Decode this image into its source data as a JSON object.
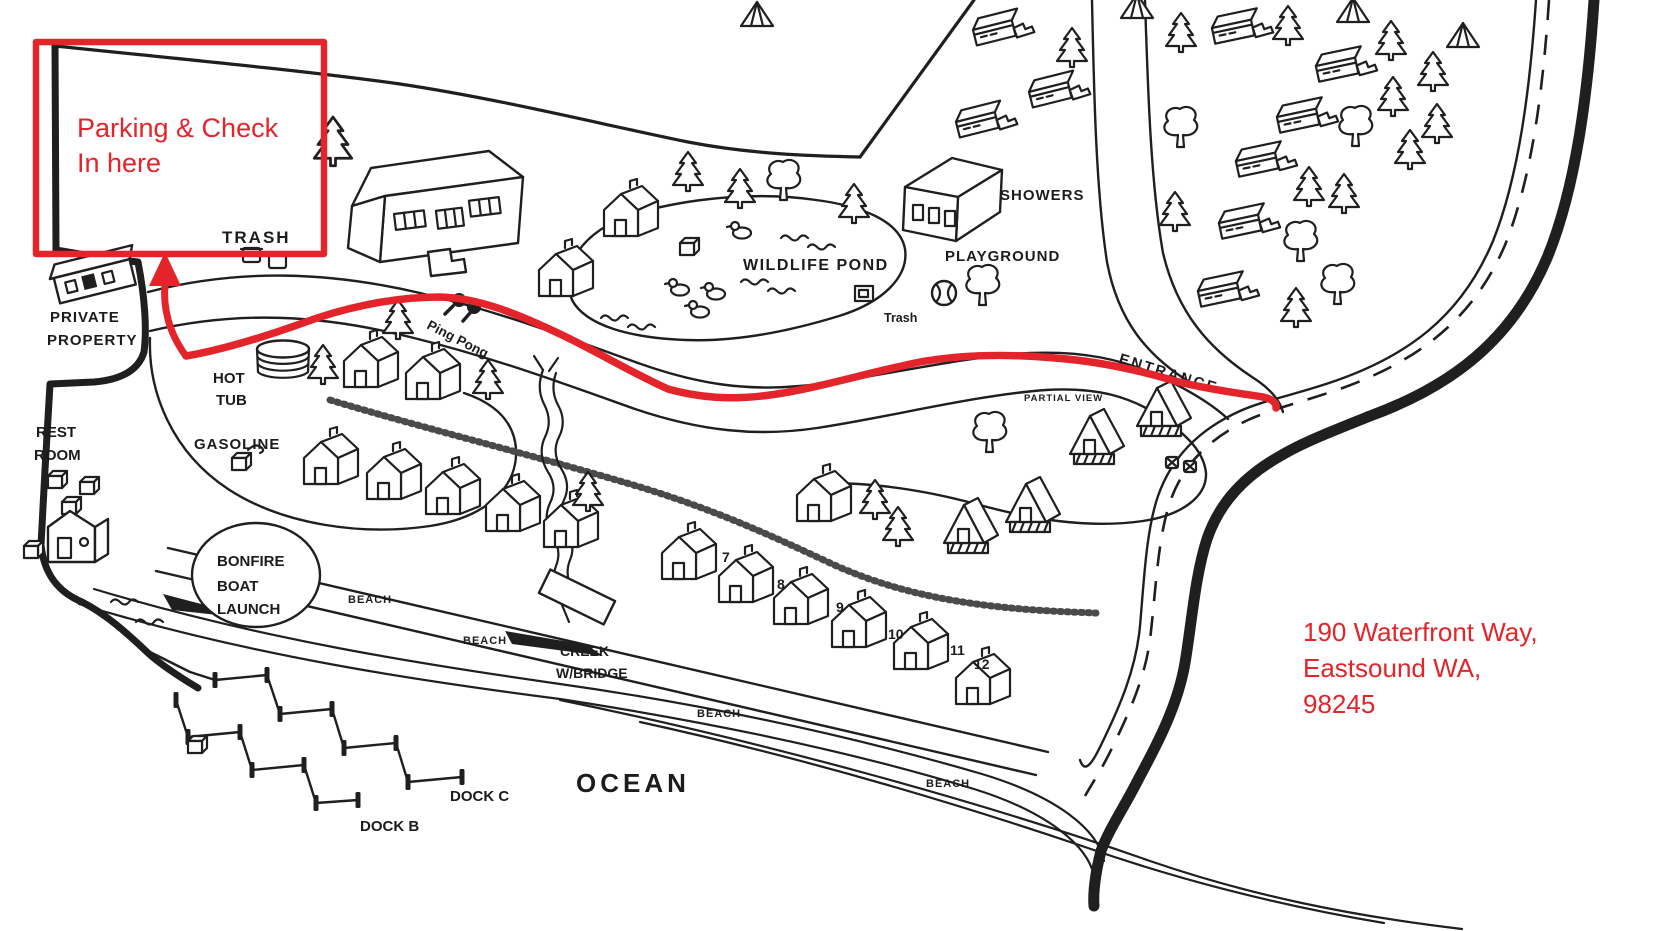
{
  "colors": {
    "annotation_red": "#e3242b",
    "map_ink": "#1f1f1f"
  },
  "red_annotations": {
    "parking_note_line1": "Parking & Check",
    "parking_note_line2": "In here",
    "address_line1": "190 Waterfront Way,",
    "address_line2": "Eastsound WA,",
    "address_line3": "98245"
  },
  "labels": {
    "trash": "TRASH",
    "private_property_line1": "PRIVATE",
    "private_property_line2": "PROPERTY",
    "rest_room_line1": "REST",
    "rest_room_line2": "ROOM",
    "hot_tub_line1": "HOT",
    "hot_tub_line2": "TUB",
    "gasoline": "GASOLINE",
    "ping_pong": "Ping Pong",
    "bonfire_line1": "BONFIRE",
    "bonfire_line2": "BOAT",
    "bonfire_line3": "LAUNCH",
    "beach": "BEACH",
    "creek_line1": "CREEK",
    "creek_line2": "W/BRIDGE",
    "ocean": "OCEAN",
    "dock_b": "DOCK B",
    "dock_c": "DOCK C",
    "wildlife_pond": "WILDLIFE POND",
    "showers": "SHOWERS",
    "playground": "PLAYGROUND",
    "trash_can": "Trash",
    "entrance": "ENTRANCE",
    "partial_view": "PARTIAL VIEW"
  },
  "cabins": {
    "numbers": [
      "7",
      "8",
      "9",
      "10",
      "11",
      "12"
    ]
  }
}
